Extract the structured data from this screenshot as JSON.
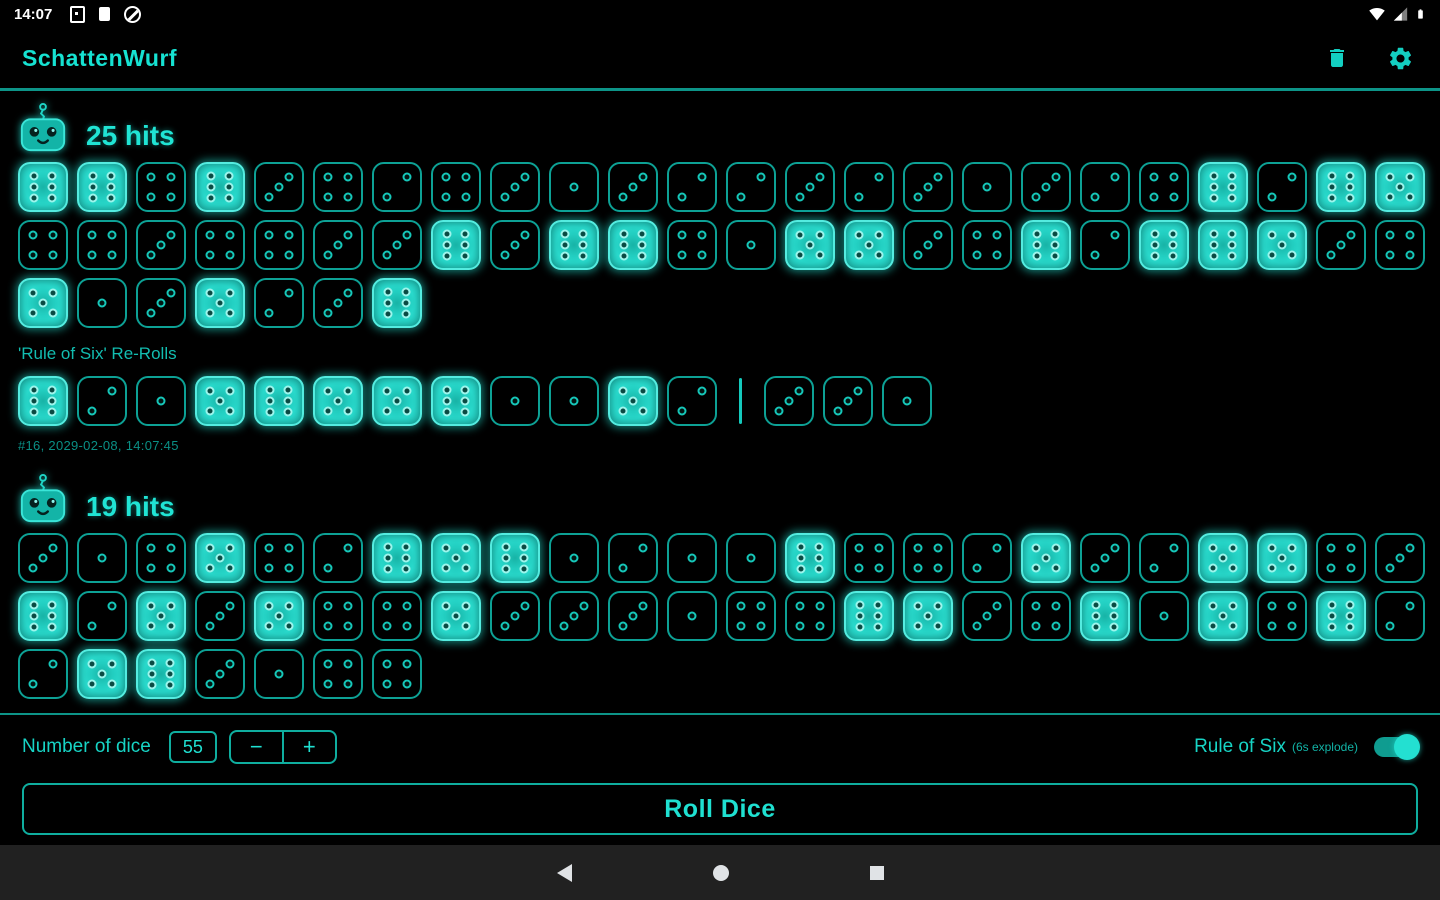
{
  "status_bar": {
    "time": "14:07",
    "left_icons": [
      "notification-square-icon",
      "notification-memory-icon",
      "data-saver-icon"
    ],
    "right_icons": [
      "wifi-icon",
      "cell-signal-icon",
      "battery-icon"
    ]
  },
  "app_bar": {
    "title": "SchattenWurf",
    "actions": [
      "delete-icon",
      "settings-icon"
    ]
  },
  "sections": [
    {
      "hits_label": "25 hits",
      "rows": [
        [
          6,
          6,
          4,
          6,
          3,
          4,
          2,
          4,
          3,
          1,
          3,
          2,
          2,
          3,
          2,
          3,
          1,
          3,
          2,
          4,
          6,
          2,
          6,
          5
        ],
        [
          4,
          4,
          3,
          4,
          4,
          3,
          3,
          6,
          3,
          6,
          6,
          4,
          1,
          5,
          5,
          3,
          4,
          6,
          2,
          6,
          6,
          5,
          3,
          4
        ],
        [
          5,
          1,
          3,
          5,
          2,
          3,
          6
        ]
      ],
      "reroll_label": "'Rule of Six' Re-Rolls",
      "reroll_groups": [
        [
          6,
          2,
          1,
          5,
          6,
          5,
          5,
          6,
          1,
          1,
          5,
          2
        ],
        [
          3,
          3,
          1
        ]
      ],
      "meta": "#16, 2029-02-08, 14:07:45"
    },
    {
      "hits_label": "19 hits",
      "rows": [
        [
          3,
          1,
          4,
          5,
          4,
          2,
          6,
          5,
          6,
          1,
          2,
          1,
          1,
          6,
          4,
          4,
          2,
          5,
          3,
          2,
          5,
          5,
          4,
          3
        ],
        [
          6,
          2,
          5,
          3,
          5,
          4,
          4,
          5,
          3,
          3,
          3,
          1,
          4,
          4,
          6,
          5,
          3,
          4,
          6,
          1,
          5,
          4,
          6,
          2
        ],
        [
          2,
          5,
          6,
          3,
          1,
          4,
          4
        ]
      ]
    }
  ],
  "controls": {
    "number_label": "Number of dice",
    "number_value": "55",
    "minus_label": "−",
    "plus_label": "+",
    "rule_of_six_label": "Rule of Six",
    "rule_of_six_sub": "(6s explode)",
    "toggle_on": true,
    "roll_button_label": "Roll Dice"
  },
  "nav_bar": {
    "icons": [
      "back-icon",
      "home-icon",
      "recents-icon"
    ]
  },
  "colors": {
    "background": "#000000",
    "accent": "#1fe0d1",
    "dice_outline": "#0da195",
    "hit_fill": "#27d9cb",
    "divider": "#0d9488",
    "meta_text": "#0a8f85",
    "nav_bar_bg": "#212121",
    "status_icons": "#ffffff"
  }
}
